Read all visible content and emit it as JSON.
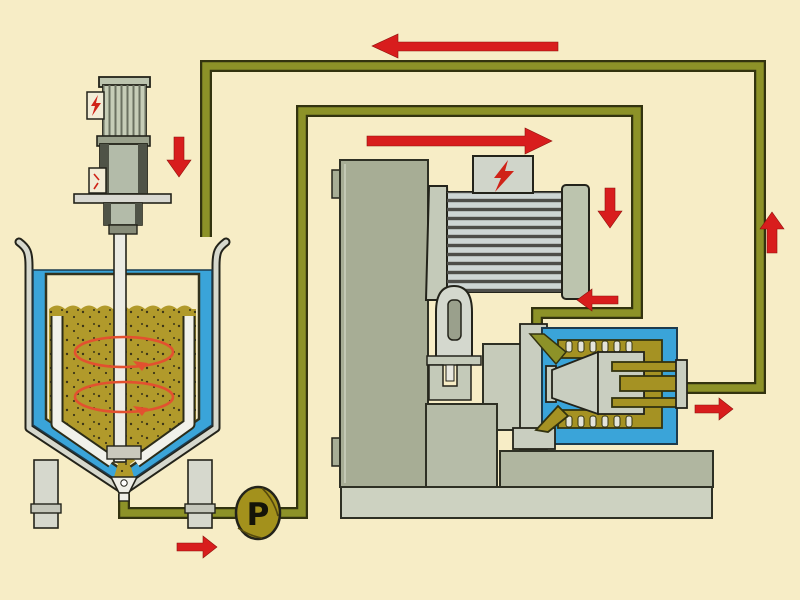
{
  "pump": {
    "label": "P"
  },
  "colors": {
    "bg": "#f7edc6",
    "pipe": "#8d9228",
    "pipedark": "#33330f",
    "pumpgold": "#a3911c",
    "product": "#b19a2b",
    "jacketblue": "#3aa4d9",
    "machine": "#a7ad95",
    "machinelight": "#cdd2c1",
    "motorbody": "#ced6d4",
    "motorcap": "#bcc4ae",
    "millolive": "#a59223",
    "red": "#d81d1d",
    "boltred": "#cf2318",
    "swirl": "#e2512f"
  },
  "icons": [
    {
      "name": "pump-icon",
      "label": "P"
    },
    {
      "name": "lightning-icon",
      "location": "agitator-motor-junction-box"
    },
    {
      "name": "lightning-icon",
      "location": "mill-motor-terminal-box"
    }
  ],
  "arrows": [
    {
      "name": "return-flow-top-arrow",
      "direction": "left",
      "size": "large"
    },
    {
      "name": "feed-flow-mid-arrow",
      "direction": "right",
      "size": "large"
    },
    {
      "name": "tank-inlet-arrow",
      "direction": "down",
      "size": "small"
    },
    {
      "name": "mill-feed-riser-arrow",
      "direction": "down",
      "size": "small"
    },
    {
      "name": "mill-inlet-arrow",
      "direction": "left",
      "size": "small"
    },
    {
      "name": "mill-outlet-arrow",
      "direction": "right",
      "size": "small"
    },
    {
      "name": "return-riser-arrow",
      "direction": "up",
      "size": "small"
    },
    {
      "name": "pump-discharge-arrow",
      "direction": "right",
      "size": "small"
    }
  ],
  "components": [
    "mixing-tank-with-cooling-jacket",
    "tank-agitator-motor",
    "agitator-shaft",
    "tank-outlet-valve",
    "circulation-pump",
    "bead-mill-machine-column",
    "mill-drive-motor",
    "mill-grinding-chamber",
    "piping-loop"
  ]
}
